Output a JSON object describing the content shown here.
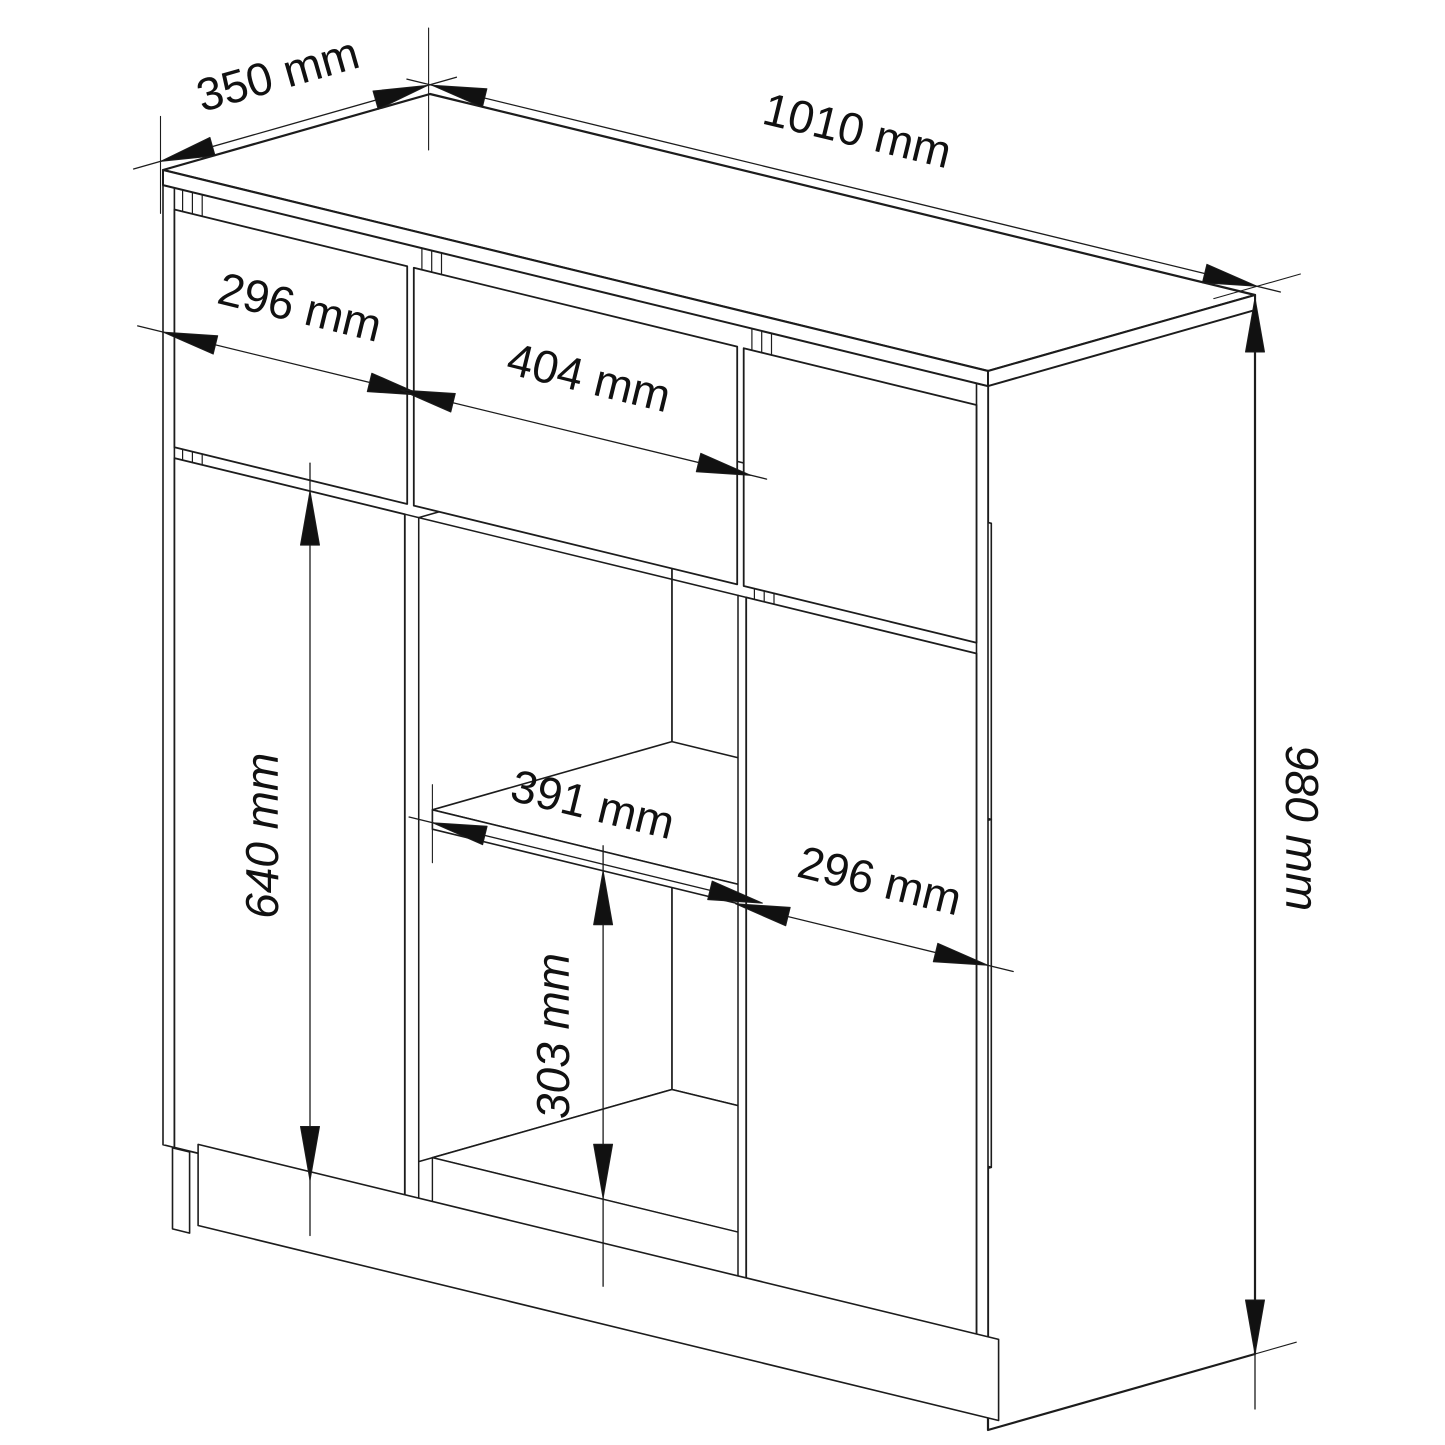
{
  "drawing": {
    "kind": "furniture-technical-drawing",
    "subject": "sideboard-isometric-view",
    "unit": "mm",
    "background_color": "#ffffff",
    "line_color": "#1c1c1c",
    "text_color": "#111111",
    "cabinet": {
      "width_mm": 1010,
      "depth_mm": 350,
      "height_mm": 980
    },
    "dimensions": [
      {
        "id": "top-depth",
        "label": "350 mm",
        "value_mm": 350
      },
      {
        "id": "top-width",
        "label": "1010 mm",
        "value_mm": 1010
      },
      {
        "id": "left-drawer-width",
        "label": "296 mm",
        "value_mm": 296
      },
      {
        "id": "middle-drawer-width",
        "label": "404 mm",
        "value_mm": 404
      },
      {
        "id": "left-door-height",
        "label": "640 mm",
        "value_mm": 640
      },
      {
        "id": "shelf-opening-width",
        "label": "391 mm",
        "value_mm": 391
      },
      {
        "id": "right-door-width",
        "label": "296 mm",
        "value_mm": 296
      },
      {
        "id": "lower-shelf-height",
        "label": "303 mm",
        "value_mm": 303
      },
      {
        "id": "overall-height",
        "label": "980 mm",
        "value_mm": 980
      }
    ]
  }
}
